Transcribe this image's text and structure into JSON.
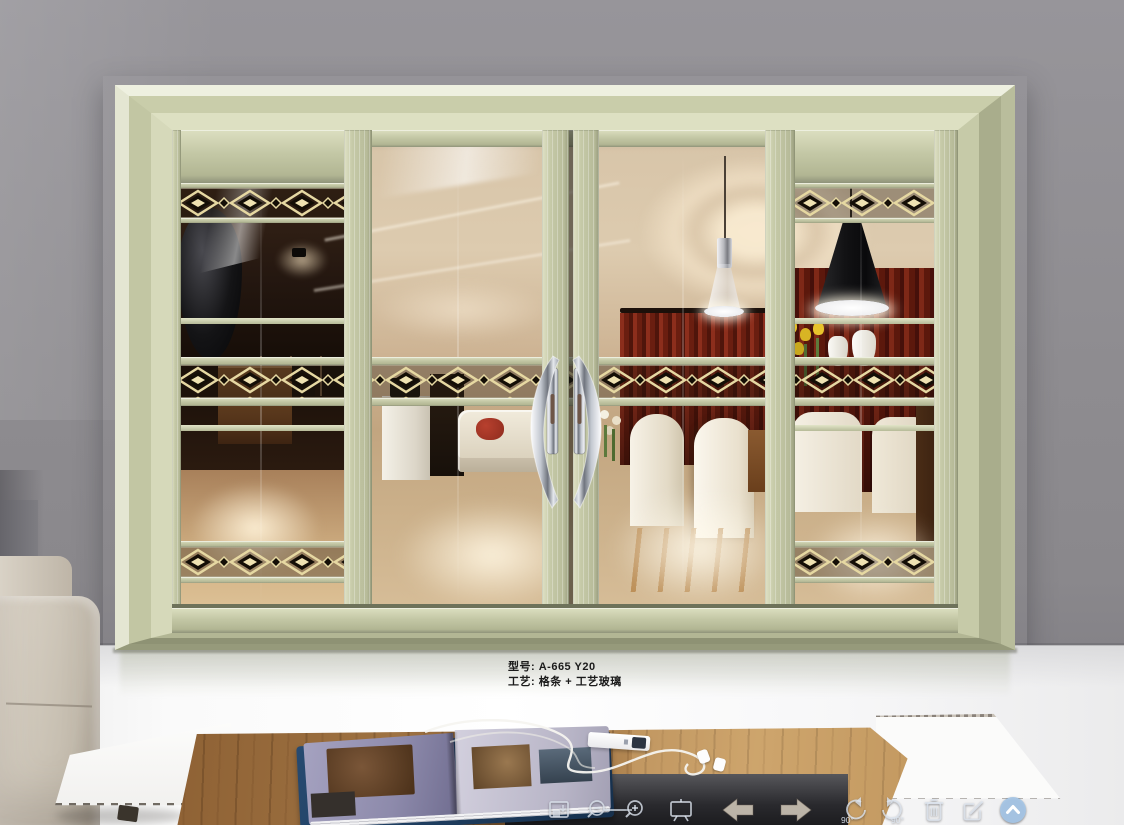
{
  "product_label": {
    "model": "型号: A-665 Y20",
    "craft": "工艺: 格条 + 工艺玻璃"
  },
  "toolbar": {
    "rotate_left_label": "90°",
    "rotate_right_label": "90°",
    "icons": [
      "save-icon",
      "zoom-out-icon",
      "zoom-in-icon",
      "slideshow-icon",
      "previous-icon",
      "next-icon",
      "rotate-left-icon",
      "rotate-right-icon",
      "delete-icon",
      "edit-icon",
      "collapse-icon"
    ]
  },
  "colors": {
    "wall_gray": "#8e8c90",
    "door_frame_champagne": "#c6caa8",
    "band_gold": "#e6d8a2",
    "band_dark": "#140e06",
    "handle_chrome": "#c3c8d0",
    "floor_white": "#f7f7f8",
    "table_wood": "#9a7248",
    "magazine_page": "#8d8aab",
    "magazine_cover": "#1e3a5c",
    "collapse_button_blue": "#a6c6e6",
    "curtain_red": "#6a1e10"
  }
}
